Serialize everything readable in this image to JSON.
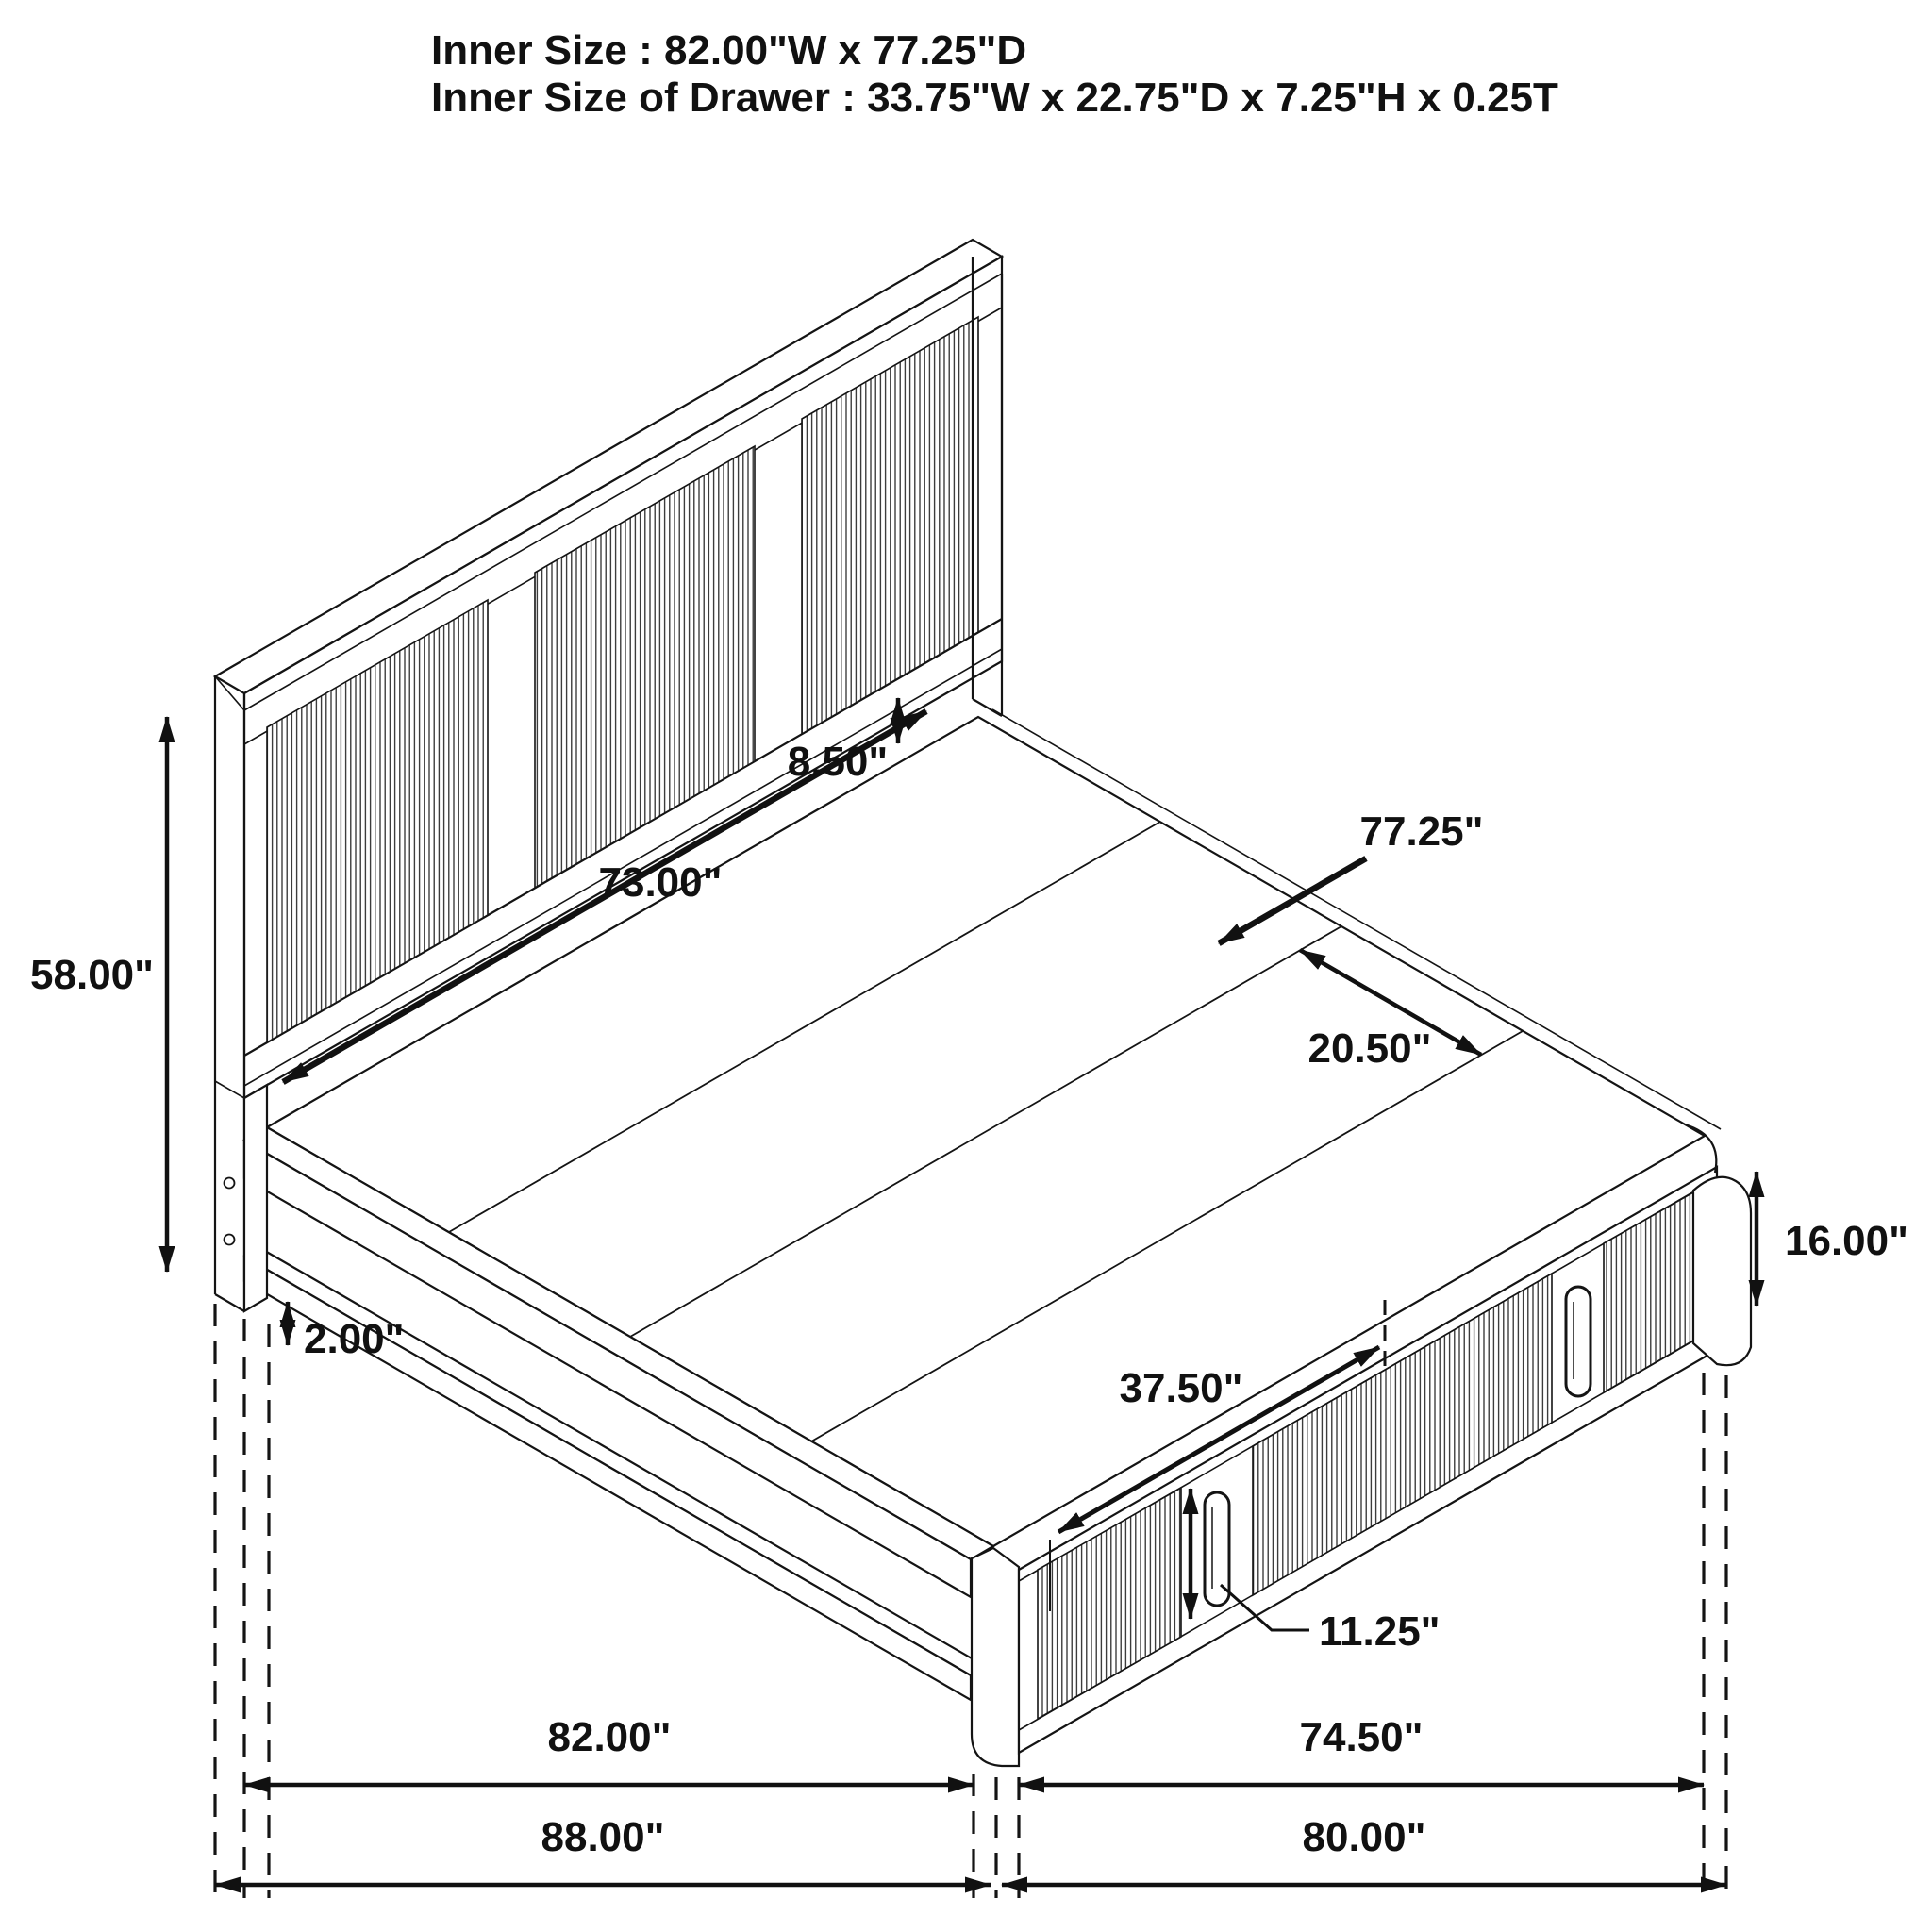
{
  "title": {
    "line1": "Inner Size : 82.00\"W x 77.25\"D",
    "line2": "Inner Size of Drawer : 33.75\"W x 22.75\"D x 7.25\"H x 0.25T"
  },
  "dimensions": {
    "headboard_height": "58.00\"",
    "floor_clearance": "2.00\"",
    "headboard_inner_width": "73.00\"",
    "headboard_rail_gap": "8.50\"",
    "platform_depth": "77.25\"",
    "slat_width": "20.50\"",
    "footboard_height": "16.00\"",
    "drawer_front_width": "37.50\"",
    "drawer_handle_height": "11.25\"",
    "side_rail_length": "82.00\"",
    "drawer_side_length": "74.50\"",
    "overall_side_length": "88.00\"",
    "overall_foot_length": "80.00\""
  },
  "colors": {
    "line": "#141414",
    "background": "#ffffff"
  }
}
